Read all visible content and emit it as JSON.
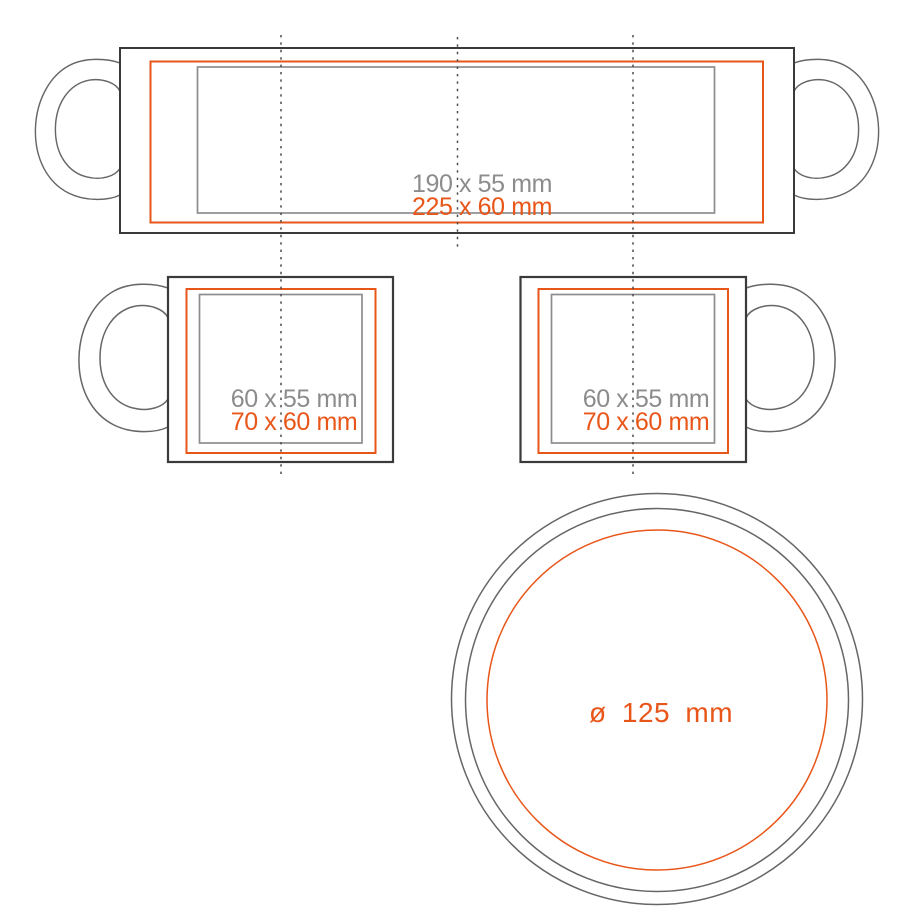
{
  "colors": {
    "accent_orange": "#e8561a",
    "label_gray": "#8c8c8c",
    "print_gray": "#8d8d8d",
    "outline_dark": "#3a3a3a",
    "outline_gray": "#666666",
    "guide_dot": "#4c4c4c"
  },
  "wrap_view": {
    "print_area_label": "190 x 55 mm",
    "bleed_area_label": "225 x 60 mm"
  },
  "left_side_view": {
    "print_area_label": "60 x 55 mm",
    "bleed_area_label": "70 x 60 mm"
  },
  "right_side_view": {
    "print_area_label": "60 x 55 mm",
    "bleed_area_label": "70 x 60 mm"
  },
  "bottom_view": {
    "diameter_label": "ø 125 mm"
  }
}
